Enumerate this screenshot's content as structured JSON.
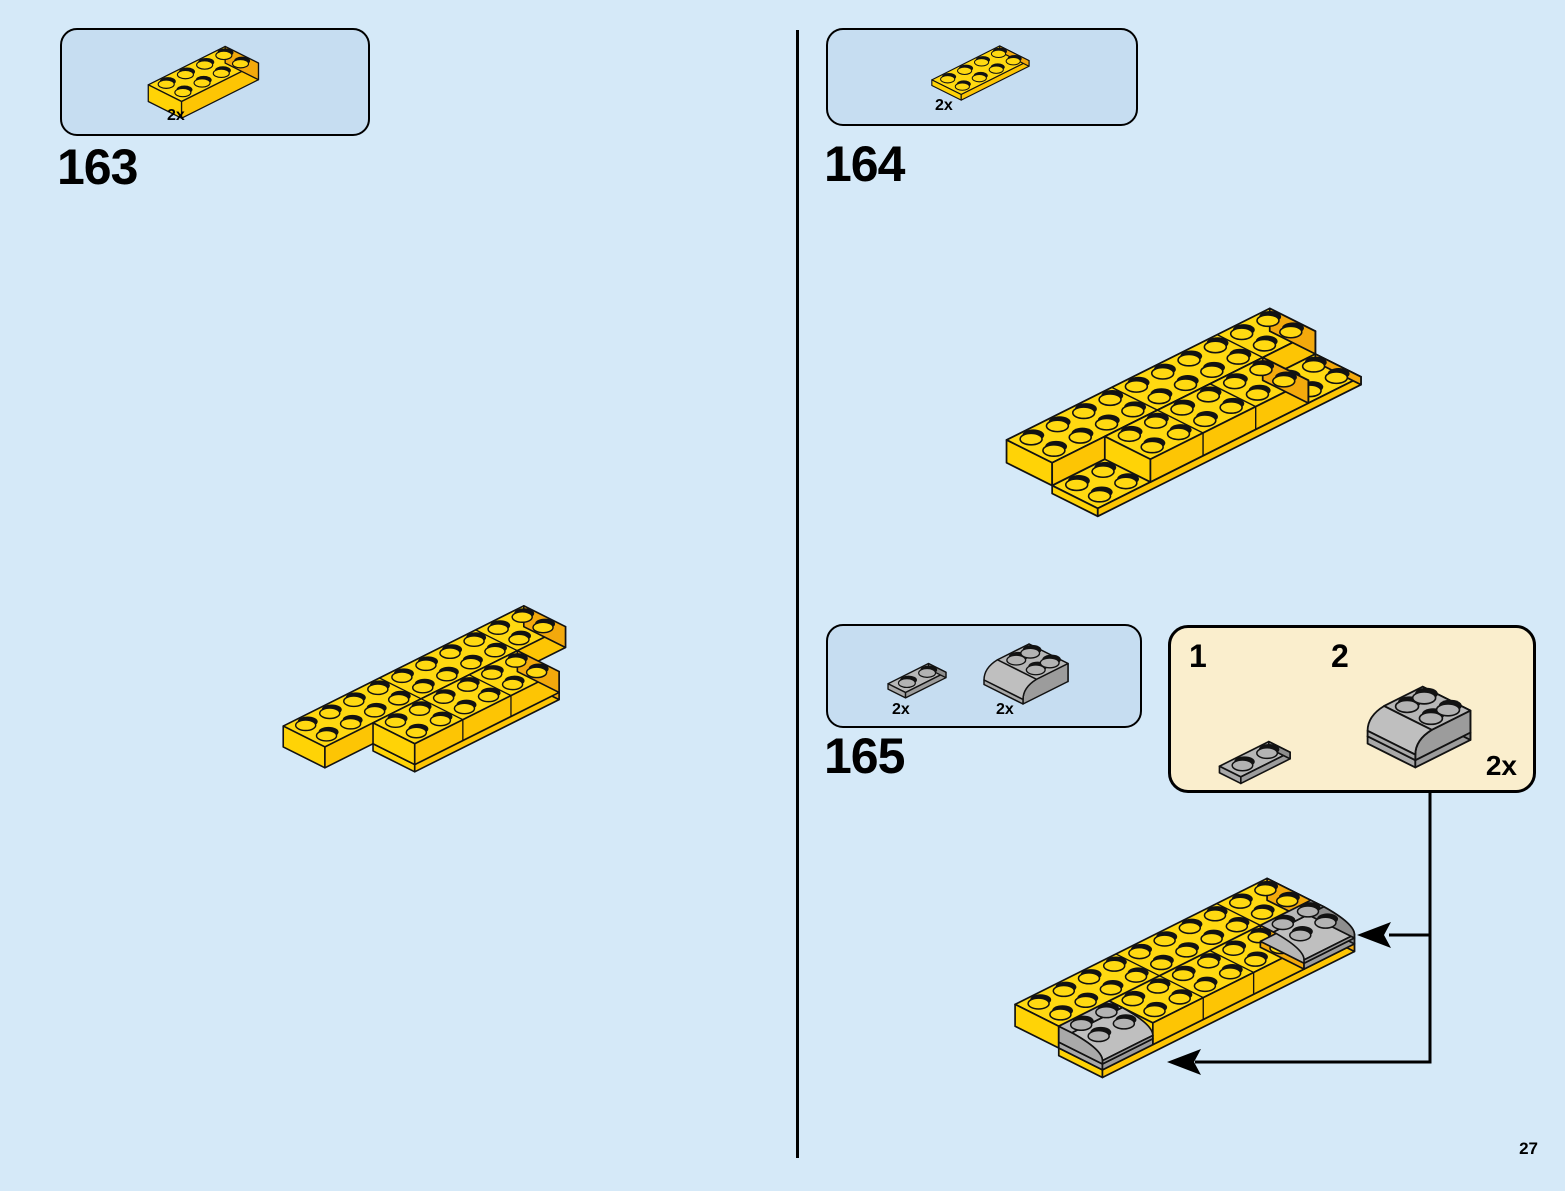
{
  "page": {
    "number": "27"
  },
  "steps": [
    {
      "id": "163",
      "parts": [
        {
          "name": "brick-2x4-yellow",
          "count": "2x"
        }
      ]
    },
    {
      "id": "164",
      "parts": [
        {
          "name": "plate-2x4-yellow",
          "count": "2x"
        }
      ]
    },
    {
      "id": "165",
      "parts": [
        {
          "name": "plate-1x2-gray",
          "count": "2x"
        },
        {
          "name": "slope-curved-2x2-gray",
          "count": "2x"
        }
      ],
      "callout": {
        "step_labels": [
          "1",
          "2"
        ],
        "count": "2x"
      }
    }
  ],
  "colors": {
    "background": "#d5e9f8",
    "parts_box_fill": "#c6ddf1",
    "callout_fill": "#faeecd",
    "outline": "#121212",
    "yellow_top": "#ffd911",
    "yellow_left": "#ffd306",
    "yellow_front": "#fdc504",
    "yellow_right": "#f3a90c",
    "gray_top": "#b7b7b7",
    "gray_band": "#bfbfbf",
    "gray_front": "#9c9c9c",
    "gray_left": "#a9a9a9",
    "gray_right": "#8e8e8e",
    "gray_stud": "#b3b3b3"
  }
}
